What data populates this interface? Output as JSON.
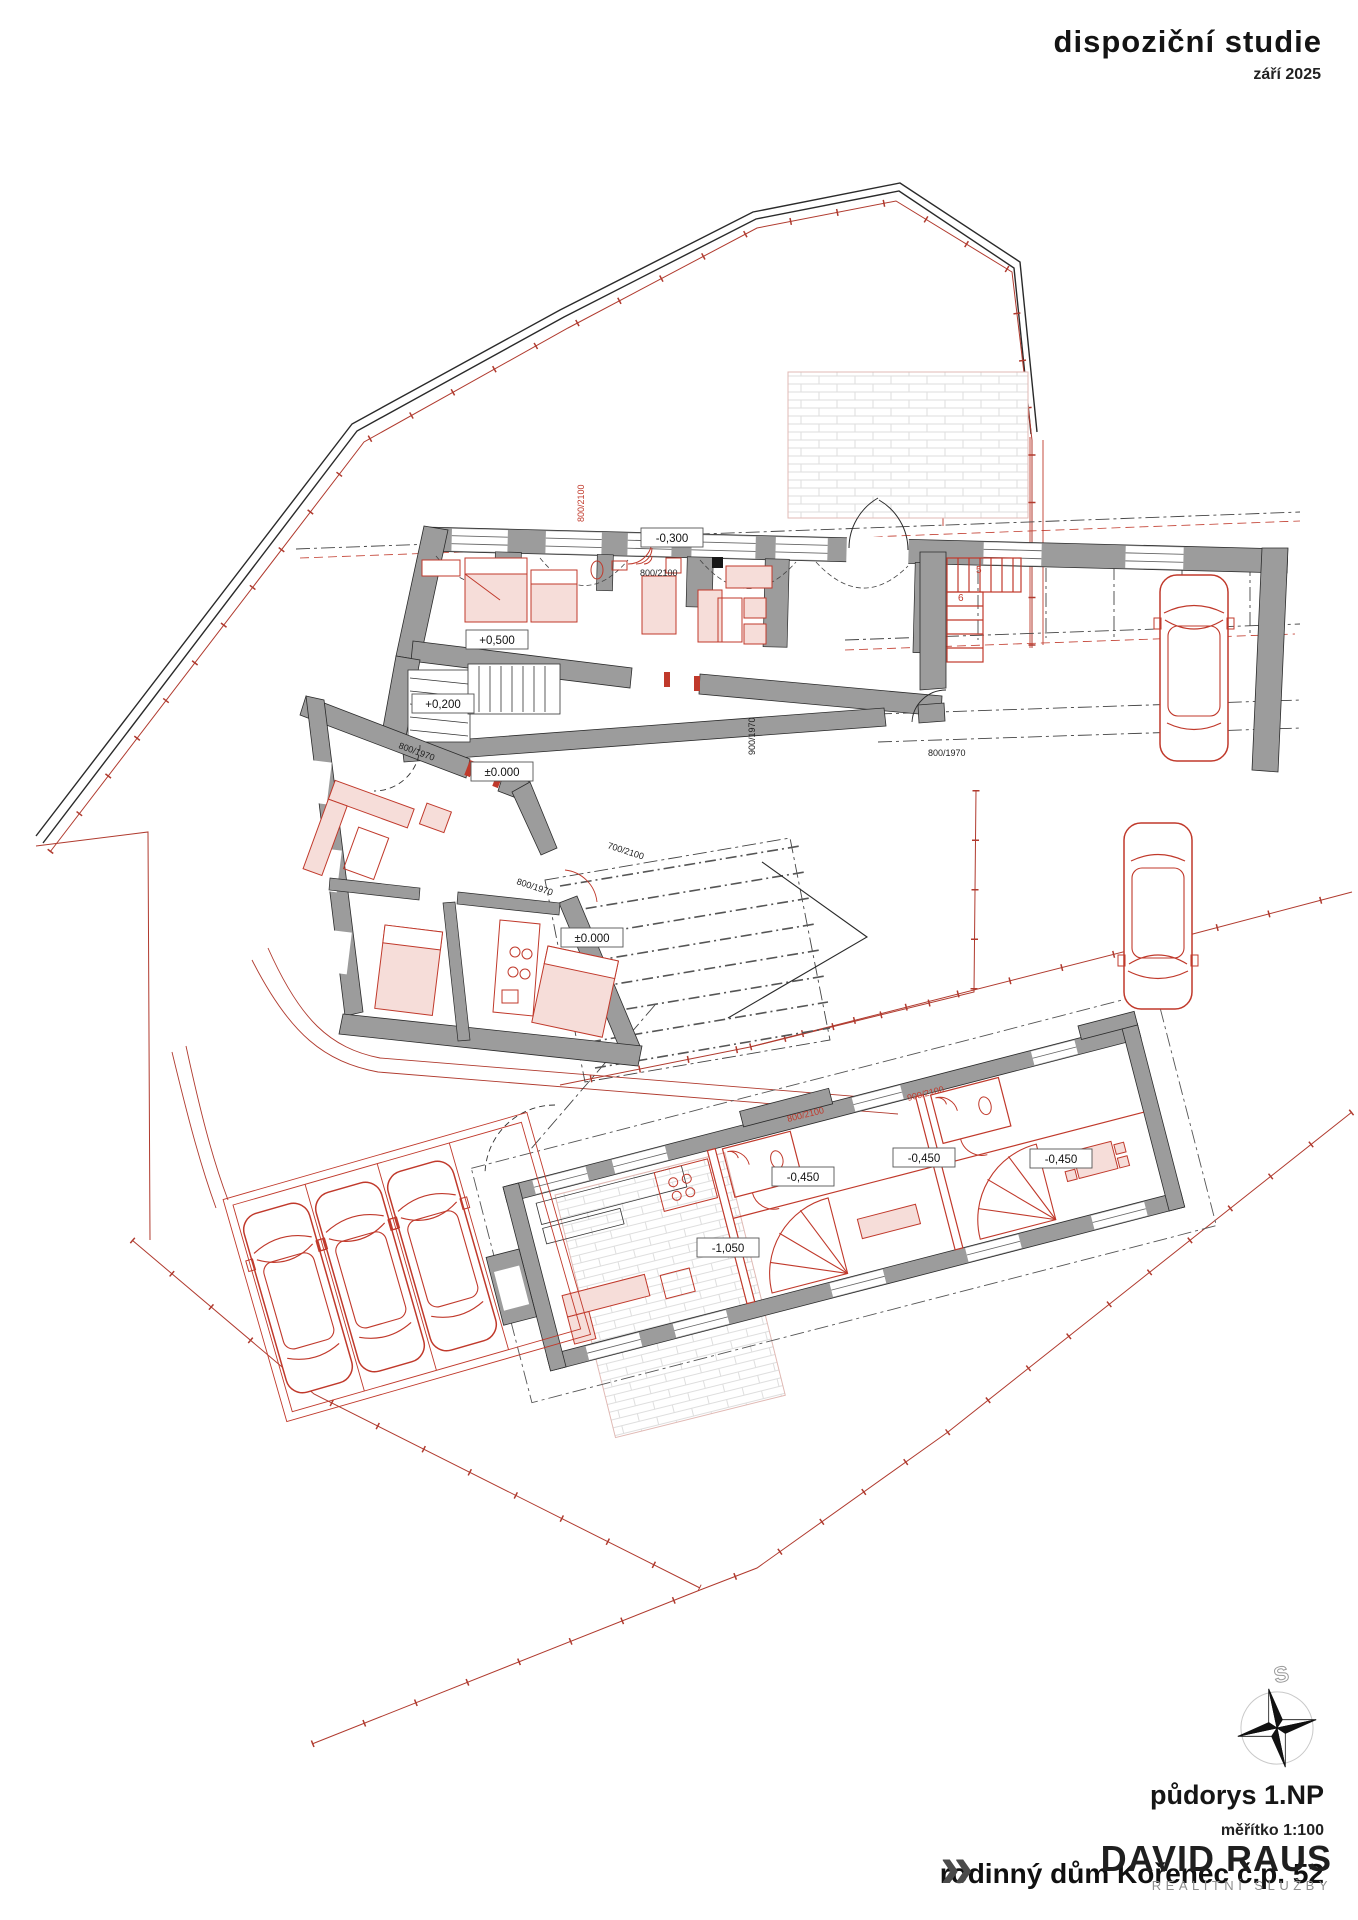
{
  "header": {
    "title": "dispoziční studie",
    "date": "září 2025"
  },
  "footer": {
    "plan_title": "půdorys 1.NP",
    "scale": "měřítko 1:100",
    "project": "rodinný dům Kořenec č.p. 52"
  },
  "brand": {
    "glyph": "»",
    "name": "DAVID RAUS",
    "tagline": "REALITNÍ SLUŽBY"
  },
  "compass": {
    "north_letter": "S"
  },
  "colors": {
    "wall_gray": "#9c9c9c",
    "cad_red": "#c0392b",
    "boundary_red": "#b03a2e",
    "furniture_pink": "#f6ddd9",
    "line_black": "#2a2a2a"
  },
  "labels": {
    "e_plus500": "+0,500",
    "e_plus200": "+0,200",
    "e_zero_hall": "±0.000",
    "e_minus300": "-0,300",
    "e_zero_wing": "±0.000",
    "e_m450_a": "-0,450",
    "e_m450_b": "-0,450",
    "e_m450_c": "-0,450",
    "e_m1050": "-1,050"
  },
  "doors": {
    "d1": "800/2100",
    "d2": "900/1970",
    "d3": "800/1970",
    "d4": "800/1970",
    "d5": "700/2100",
    "d6": "800/1970",
    "d7": "800/2100",
    "d8": "900/2100",
    "d9": "800/2100"
  },
  "stair_numbers": {
    "s5": "5",
    "s6": "6"
  }
}
